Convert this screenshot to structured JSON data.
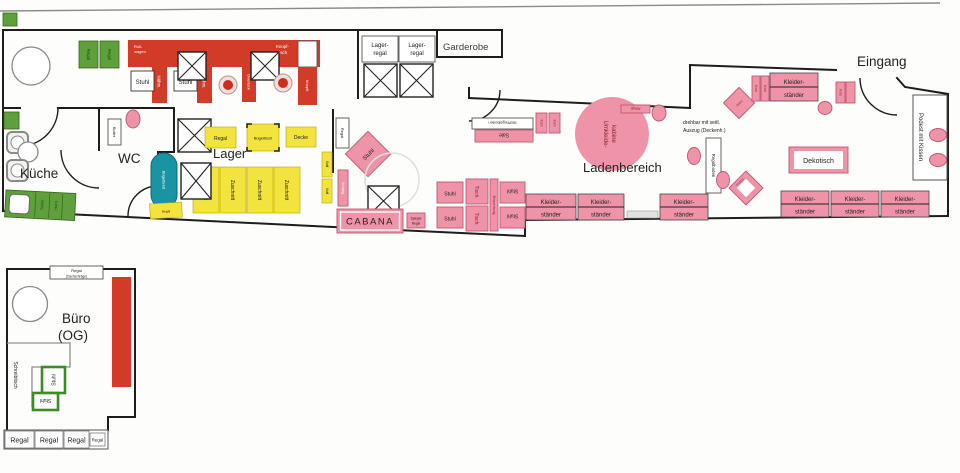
{
  "labels": {
    "kueche": "Küche",
    "wc": "WC",
    "lager": "Lager",
    "ladenbereich": "Ladenbereich",
    "eingang": "Eingang",
    "garderobe": "Garderobe",
    "cabana": "CABANA",
    "buero1": "Büro",
    "buero2": "(OG)",
    "stuhl": "Stuhl",
    "regal": "Regal",
    "zuschnitt": "Zuschnitt",
    "kleider1": "Kleider-",
    "kleider2": "ständer",
    "lagerregal1": "Lager-",
    "lagerregal2": "regal",
    "dekotisch": "Dekotisch",
    "podest": "Podest mit Kissen",
    "umkleide1": "Umkleide-",
    "umkleide2": "kabine",
    "stoffregalboden": "Stoffregalboden",
    "sale": "Sale",
    "regalboden": "Regalboden",
    "drehbar1": "drehbar mit seitl.",
    "drehbar2": "Auszug (Deckenh.)",
    "schreibtisch": "Schreibtisch",
    "naehm": "Nähm.",
    "overlock": "Overlock",
    "knopfl": "Knopfl.",
    "knopf1": "Knopf-",
    "knopf2": "tisch",
    "roll1": "Roll-",
    "roll2": "wagen",
    "buegelbrett": "Bügelbrett",
    "buegeltisch": "Bügeltisch",
    "decke": "Decke",
    "tisch": "Tisch",
    "vorhang": "Vorhang",
    "spiegel": "Spiegel",
    "korb": "Korb",
    "boiler": "Boiler",
    "stoff": "Stoff",
    "ablage": "Ablage",
    "deko": "Deko",
    "hocker": "Hocker",
    "besprechung": "Besprechung",
    "dachschraege": "(Dachschräge)",
    "spuele": "Spüle",
    "herd": "Herd"
  },
  "colors": {
    "red": "#d23b27",
    "yellow": "#f3e33d",
    "green": "#5fa03c",
    "pink": "#ef94a8",
    "teal": "#1a93a5",
    "wall": "#1d1d1d"
  }
}
